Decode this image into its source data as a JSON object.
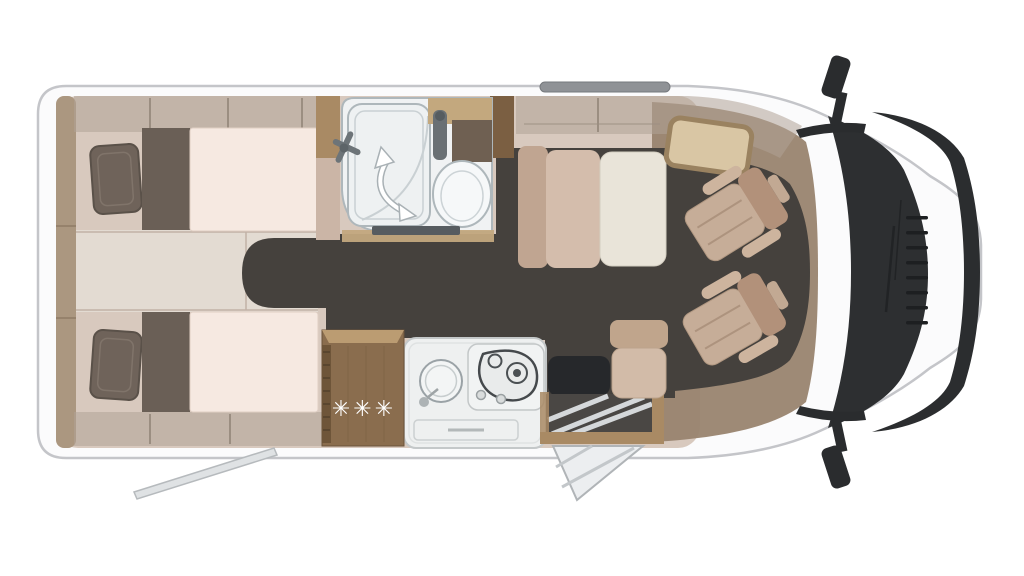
{
  "fridge": {
    "freezer_rating": "✳✳✳"
  },
  "colors": {
    "page_bg": "#ffffff",
    "body_fill": "#fbfbfc",
    "body_stroke": "#c4c5c9",
    "floor": "#d8c9be",
    "floor_light": "#e3dbd2",
    "wall_band": "#b0a396",
    "wall_wood": "#ab9780",
    "wood": "#a98a64",
    "wood_dark": "#7b5f42",
    "wood_light": "#c3a87e",
    "dark_floor": "#45413d",
    "cab_brown": "#99846f",
    "mattress": "#f6e9e1",
    "bed_dark": "#6a5f56",
    "pillow": "#6f635a",
    "seat_blush": "#d4bdac",
    "seat_blush_dark": "#c0a591",
    "seat_cream": "#e9e4d9",
    "cab_seat": "#c6ad98",
    "cab_seat_dark": "#b2917a",
    "bath": "#f0f2f3",
    "bath_stroke": "#aeb7bb",
    "counter": "#eef0f0",
    "glass": "#2d2f31",
    "mirror": "#2a2c2e",
    "steel": "#d5d8da",
    "fridge_wood": "#8a6d4e",
    "fridge_top": "#bb9c72",
    "recess": "#26282b",
    "door_panel": "#eceef0",
    "star": "#ffffff"
  }
}
